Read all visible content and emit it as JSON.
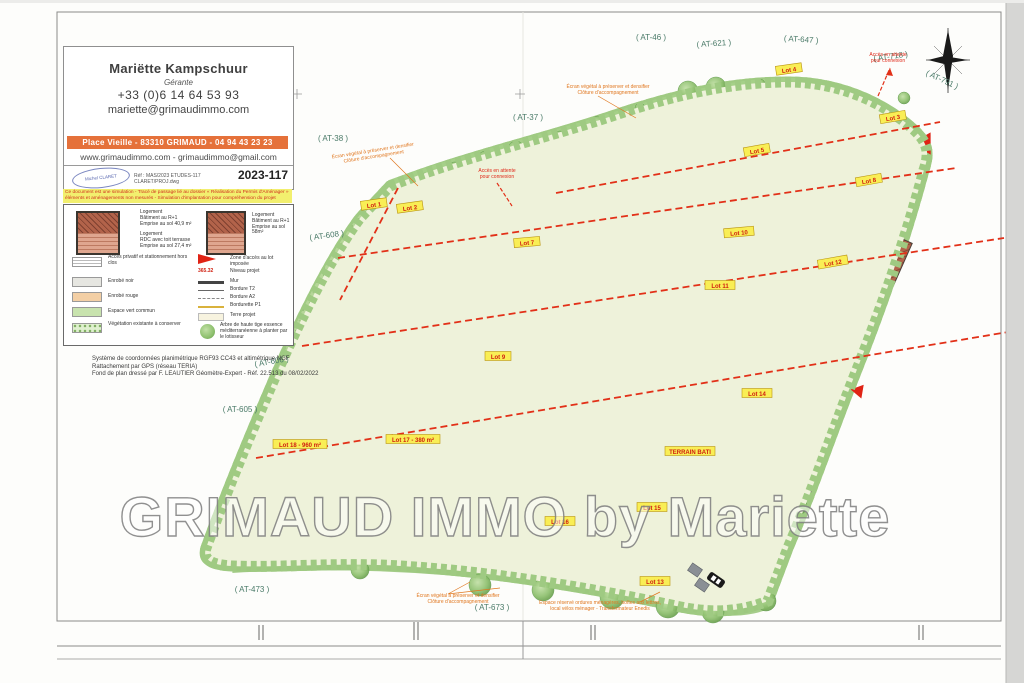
{
  "watermark": "GRIMAUD IMMO by Mariette",
  "card": {
    "name": "Mariëtte Kampschuur",
    "role": "Gérante",
    "phone": "+33 (0)6 14 64 53 93",
    "email": "mariette@grimaudimmo.com",
    "address_bar": "Place Vieille - 83310 GRIMAUD - 04 94 43 23 23",
    "web_line": "www.grimaudimmo.com - grimaudimmo@gmail.com",
    "stamp": "Michel CLARET",
    "file_ref": "Réf : MAS/2023 ETUDES-117 CLARET/PROJ.dwg",
    "doc_number": "2023-117"
  },
  "note_banner": {
    "line1": "Ce document est une simulation - Tracé de passage lié au dossier « Réalisation du Permis d'Aménager »",
    "line2": "éléments et aménagements non mesurés - Simulation d'implantation pour compréhension du projet"
  },
  "legend": {
    "building_r1": [
      "Logement",
      "Bâtiment au R+1",
      "Emprise au sol 40,9 m²"
    ],
    "building_rdc": [
      "Logement",
      "RDC avec toit terrasse",
      "Emprise au sol 27,4 m²"
    ],
    "building_r1_58": [
      "Logement",
      "Bâtiment au R+1",
      "Emprise au sol 58m²"
    ],
    "acces_privatif": "Accès privatif et stationnement hors clos",
    "enrobe_noir": "Enrobé noir",
    "enrobe_rouge": "Enrobé rouge",
    "espace_vert": "Espace vert commun",
    "vegetation": "Végétation existante à conserver",
    "zone_acces": "Zone d'accès au lot imposée",
    "niveau_sample": "365.32",
    "niveau_projet": "Niveau projet",
    "mur": "Mur",
    "bordure_t2": "Bordure T2",
    "bordure_a2": "Bordure A2",
    "bordurette_p1": "Bordurette P1",
    "terre_projet": "Terre projet",
    "arbre": "Arbre de haute tige essence méditerranéenne à planter par le lotisseur"
  },
  "survey_note": {
    "line1": "Système de coordonnées planimétrique RGF93 CC43 et altimétrique NGF",
    "line2": "Rattachement par GPS (réseau TERIA)",
    "line3": "Fond de plan dressé par F. LEAUTIER Géomètre-Expert - Réf. 22.513 du 08/02/2022"
  },
  "parcels": [
    {
      "text": "( AT-46 )"
    },
    {
      "text": "( AT-621 )"
    },
    {
      "text": "( AT-647 )"
    },
    {
      "text": "( AT-718 )"
    },
    {
      "text": "( AT-791 )"
    },
    {
      "text": "( AT-37 )"
    },
    {
      "text": "( AT-38 )"
    },
    {
      "text": "( AT-608 )"
    },
    {
      "text": "( AT-606 )"
    },
    {
      "text": "( AT-605 )"
    },
    {
      "text": "( AT-473 )"
    },
    {
      "text": "( AT-673 )"
    }
  ],
  "lots": [
    {
      "text": "Lot 1"
    },
    {
      "text": "Lot 2"
    },
    {
      "text": "Lot 3"
    },
    {
      "text": "Lot 4"
    },
    {
      "text": "Lot 5"
    },
    {
      "text": "Lot 7"
    },
    {
      "text": "Lot 8"
    },
    {
      "text": "Lot 9"
    },
    {
      "text": "Lot 10"
    },
    {
      "text": "Lot 11"
    },
    {
      "text": "Lot 12"
    },
    {
      "text": "Lot 13"
    },
    {
      "text": "Lot 14"
    },
    {
      "text": "Lot 15"
    },
    {
      "text": "Lot 16"
    },
    {
      "text": "Lot 17 - 380 m²"
    },
    {
      "text": "Lot 18 - 960 m²"
    },
    {
      "text": "TERRAIN BATI"
    }
  ],
  "map_notes": {
    "ecran": {
      "line1": "Écran végétal à préserver et densifier",
      "line2": "Clôture d'accompagnement"
    },
    "acces": {
      "line1": "Accès en attente",
      "line2": "pour connexion"
    },
    "espace": {
      "line1": "Espace réservé ordures ménagères, boîtes aux lettres,",
      "line2": "local vélos ménager - Transformateur Enedis"
    }
  }
}
